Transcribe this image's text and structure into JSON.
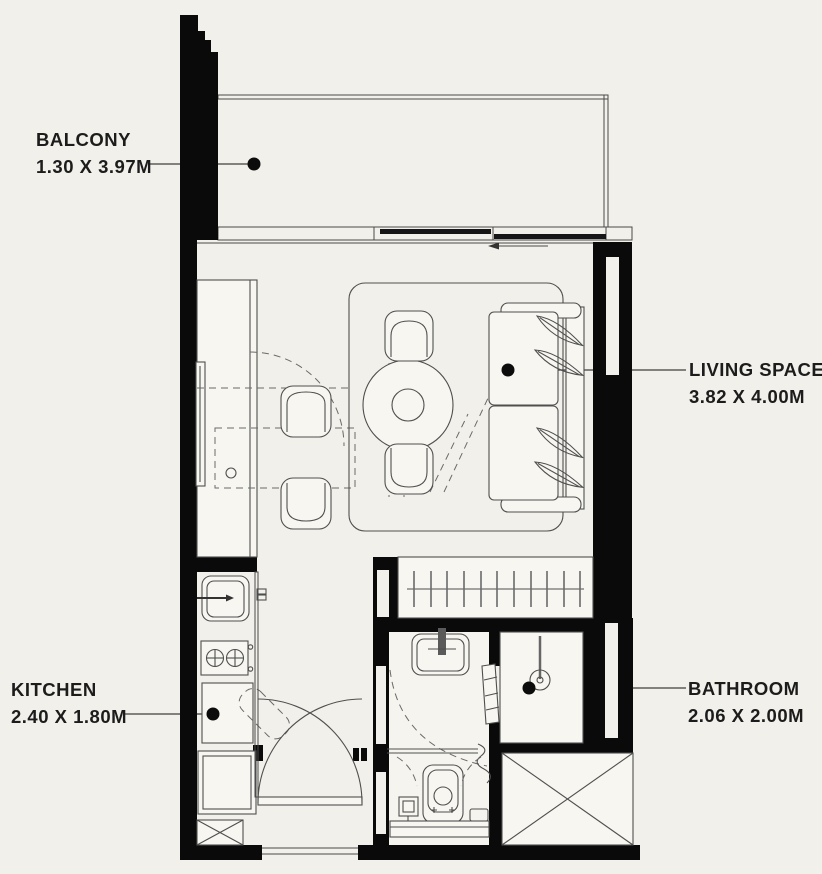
{
  "title": "Studio apartment floor plan",
  "colors": {
    "background": "#f2f0ea",
    "wall": "#0a0a0a",
    "line": "#4a4a4a",
    "text": "#1c1c1c"
  },
  "rooms": {
    "balcony": {
      "name": "BALCONY",
      "dims": "1.30 X 3.97M"
    },
    "living": {
      "name": "LIVING SPACE",
      "dims": "3.82 X 4.00M"
    },
    "kitchen": {
      "name": "KITCHEN",
      "dims": "2.40 X 1.80M"
    },
    "bathroom": {
      "name": "BATHROOM",
      "dims": "2.06 X 2.00M"
    }
  },
  "fixtures": [
    "sofa",
    "dining-table",
    "dining-chair",
    "rug",
    "tv",
    "counter",
    "wardrobe",
    "kitchen-sink",
    "stove",
    "fridge",
    "entry-door",
    "bathroom-sink",
    "toilet",
    "shower",
    "service-shaft",
    "sliding-window",
    "balcony-railing"
  ]
}
